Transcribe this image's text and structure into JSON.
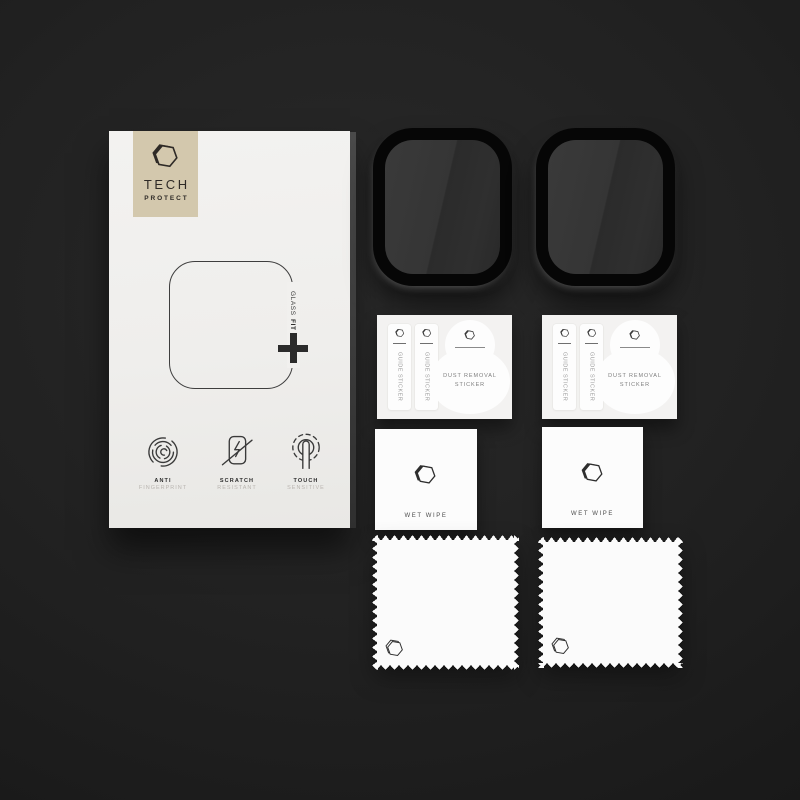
{
  "colors": {
    "background": "#1e1e1e",
    "box_face": "#f1f0ee",
    "brand_badge": "#d3c8ad",
    "ink": "#2e2a26",
    "muted_label": "#b9b5b0",
    "protector_rim": "#060606",
    "protector_screen": "#303030",
    "sticker_white": "#fdfdfd"
  },
  "box": {
    "brand": {
      "line1": "TECH",
      "line2": "PROTECT"
    },
    "glass_fit": {
      "word1": "GLASS",
      "word2": "FIT"
    },
    "features": [
      {
        "icon": "fingerprint-icon",
        "title": "ANTI",
        "subtitle": "FINGERPRINT"
      },
      {
        "icon": "scratch-resistant-icon",
        "title": "SCRATCH",
        "subtitle": "RESISTANT"
      },
      {
        "icon": "touch-sensitive-icon",
        "title": "TOUCH",
        "subtitle": "SENSITIVE"
      }
    ]
  },
  "protectors": {
    "count": 2,
    "description": "black rounded watch glass protectors"
  },
  "sticker_cards": [
    {
      "strips": [
        {
          "label": "GUIDE STICKER"
        },
        {
          "label": "GUIDE STICKER"
        }
      ],
      "dust_sticker": {
        "line1": "DUST REMOVAL",
        "line2": "STICKER"
      }
    },
    {
      "strips": [
        {
          "label": "GUIDE STICKER"
        },
        {
          "label": "GUIDE STICKER"
        }
      ],
      "dust_sticker": {
        "line1": "DUST REMOVAL",
        "line2": "STICKER"
      }
    }
  ],
  "wet_wipes": [
    {
      "label": "WET WIPE"
    },
    {
      "label": "WET WIPE"
    }
  ],
  "cloths": {
    "count": 2
  }
}
